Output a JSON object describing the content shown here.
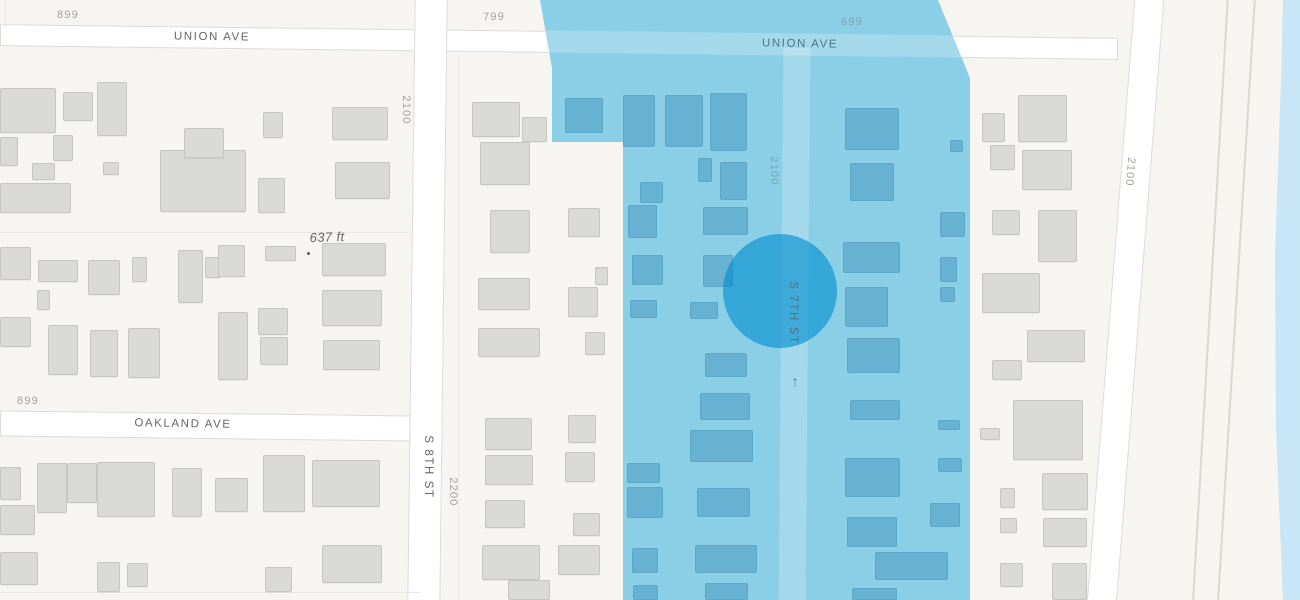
{
  "map": {
    "description": "street map with highlighted zone and circular marker",
    "colors": {
      "background": "#f6f5f1",
      "street": "#ffffff",
      "street_border": "#dcdbd5",
      "building": "#d9d9d7",
      "zone_fill": "#8bcfe7",
      "zone_building": "#67b2d3",
      "marker_circle": "rgba(0,140,206,0.62)",
      "water": "#c9e5f8",
      "street_name_text": "#666666",
      "block_number_text": "#a2a19e",
      "zone_name_text": "#4c7485",
      "zone_number_text": "#7fa2ad"
    },
    "streets": [
      {
        "cls": "street",
        "x": 0,
        "y": 31,
        "w": 1118,
        "h": 22,
        "rot": 0.7
      },
      {
        "cls": "street",
        "x": 0,
        "y": 413,
        "w": 416,
        "h": 26,
        "rot": 0.7
      },
      {
        "cls": "street",
        "x": 411,
        "y": -6,
        "w": 33,
        "h": 614,
        "rot": 0.7
      },
      {
        "cls": "street",
        "x": 1110,
        "y": -12,
        "w": 30,
        "h": 640,
        "rot": 4.5
      },
      {
        "cls": "path",
        "x": 1209,
        "y": -8,
        "w": 2,
        "h": 630,
        "rot": 3.3
      },
      {
        "cls": "path",
        "x": 1235,
        "y": -8,
        "w": 2,
        "h": 630,
        "rot": 3.5
      },
      {
        "cls": "hairline",
        "x": 5,
        "y": 0,
        "w": 1,
        "h": 28
      },
      {
        "cls": "hairline",
        "x": 0,
        "y": 232,
        "w": 408,
        "h": 1
      },
      {
        "cls": "hairline",
        "x": 0,
        "y": 592,
        "w": 420,
        "h": 1
      },
      {
        "cls": "hairline",
        "x": 458,
        "y": 55,
        "w": 1,
        "h": 545
      }
    ],
    "labels": [
      {
        "text": "899",
        "x": 68,
        "y": 15,
        "rot": 0,
        "cls": "num",
        "name": "label-block-number"
      },
      {
        "text": "UNION AVE",
        "x": 212,
        "y": 37,
        "rot": 0.7,
        "cls": "name",
        "name": "label-street-name"
      },
      {
        "text": "799",
        "x": 494,
        "y": 17,
        "rot": -1,
        "cls": "num",
        "name": "label-block-number"
      },
      {
        "text": "2100",
        "x": 406,
        "y": 110,
        "rot": 90,
        "cls": "num",
        "name": "label-block-number"
      },
      {
        "text": "2100",
        "x": 1130,
        "y": 172,
        "rot": 95,
        "cls": "num",
        "name": "label-block-number"
      },
      {
        "text": "637 ft",
        "x": 327,
        "y": 237,
        "rot": -2,
        "cls": "elev",
        "name": "label-elevation"
      },
      {
        "text": "899",
        "x": 28,
        "y": 401,
        "rot": 0,
        "cls": "num",
        "name": "label-block-number"
      },
      {
        "text": "OAKLAND AVE",
        "x": 183,
        "y": 424,
        "rot": 1,
        "cls": "name",
        "name": "label-street-name"
      },
      {
        "text": "S 8TH ST",
        "x": 428,
        "y": 467,
        "rot": 90,
        "cls": "name",
        "name": "label-street-name"
      },
      {
        "text": "2200",
        "x": 453,
        "y": 492,
        "rot": 90,
        "cls": "num",
        "name": "label-block-number"
      }
    ],
    "zone_labels": [
      {
        "text": "699",
        "x": 852,
        "y": 22,
        "rot": -1,
        "cls": "num on-zone",
        "name": "label-block-number"
      },
      {
        "text": "UNION AVE",
        "x": 800,
        "y": 44,
        "rot": 1,
        "cls": "name on-zone",
        "name": "label-street-name"
      },
      {
        "text": "2100",
        "x": 774,
        "y": 171,
        "rot": 90,
        "cls": "num on-zone",
        "name": "label-block-number"
      },
      {
        "text": "S 7TH ST",
        "x": 793,
        "y": 313,
        "rot": 90,
        "cls": "name on-zone",
        "name": "label-street-name"
      }
    ],
    "zone": {
      "polygon": [
        [
          540,
          0
        ],
        [
          938,
          0
        ],
        [
          970,
          78
        ],
        [
          970,
          600
        ],
        [
          623,
          600
        ],
        [
          623,
          142
        ],
        [
          552,
          142
        ],
        [
          552,
          68
        ]
      ],
      "inner_streets": [
        {
          "x": 538,
          "y": 33,
          "w": 436,
          "h": 22,
          "rot": 0.7
        },
        {
          "x": 781,
          "y": 48,
          "w": 27,
          "h": 552,
          "rot": 0.5
        }
      ],
      "circle": {
        "cx": 780,
        "cy": 291,
        "r": 57
      },
      "arrow": {
        "x": 795,
        "y": 382,
        "glyph": "↑"
      }
    },
    "elevation_dot": {
      "x": 307,
      "y": 252
    },
    "water": {
      "polygon": [
        [
          1283,
          0
        ],
        [
          1300,
          0
        ],
        [
          1300,
          600
        ],
        [
          1283,
          600
        ],
        [
          1276,
          430
        ],
        [
          1275,
          255
        ],
        [
          1281,
          80
        ]
      ]
    },
    "buildings": {
      "gray": [
        [
          0,
          88,
          56,
          45
        ],
        [
          63,
          92,
          30,
          29
        ],
        [
          97,
          82,
          30,
          54
        ],
        [
          0,
          137,
          18,
          29
        ],
        [
          53,
          135,
          20,
          26
        ],
        [
          32,
          163,
          23,
          17
        ],
        [
          103,
          162,
          16,
          13
        ],
        [
          0,
          183,
          71,
          30
        ],
        [
          160,
          150,
          86,
          62
        ],
        [
          184,
          128,
          40,
          30
        ],
        [
          263,
          112,
          20,
          26
        ],
        [
          258,
          178,
          27,
          35
        ],
        [
          332,
          107,
          56,
          33
        ],
        [
          335,
          162,
          55,
          37
        ],
        [
          0,
          247,
          31,
          33
        ],
        [
          38,
          260,
          40,
          22
        ],
        [
          37,
          290,
          13,
          20
        ],
        [
          88,
          260,
          32,
          35
        ],
        [
          132,
          257,
          15,
          25
        ],
        [
          178,
          250,
          25,
          53
        ],
        [
          205,
          257,
          15,
          21
        ],
        [
          218,
          245,
          27,
          32
        ],
        [
          265,
          246,
          31,
          15
        ],
        [
          322,
          243,
          64,
          33
        ],
        [
          0,
          317,
          31,
          30
        ],
        [
          48,
          325,
          30,
          50
        ],
        [
          90,
          330,
          28,
          47
        ],
        [
          128,
          328,
          32,
          50
        ],
        [
          218,
          312,
          30,
          68
        ],
        [
          258,
          308,
          30,
          27
        ],
        [
          260,
          337,
          28,
          28
        ],
        [
          322,
          290,
          60,
          36
        ],
        [
          323,
          340,
          57,
          30
        ],
        [
          0,
          467,
          21,
          33
        ],
        [
          37,
          463,
          30,
          50
        ],
        [
          67,
          463,
          30,
          40
        ],
        [
          97,
          462,
          58,
          55
        ],
        [
          172,
          468,
          30,
          49
        ],
        [
          215,
          478,
          33,
          34
        ],
        [
          263,
          455,
          42,
          57
        ],
        [
          312,
          460,
          68,
          47
        ],
        [
          0,
          505,
          35,
          30
        ],
        [
          0,
          552,
          38,
          33
        ],
        [
          97,
          562,
          23,
          30
        ],
        [
          127,
          563,
          21,
          24
        ],
        [
          265,
          567,
          27,
          25
        ],
        [
          322,
          545,
          60,
          38
        ],
        [
          472,
          102,
          48,
          35
        ],
        [
          522,
          117,
          25,
          25
        ],
        [
          480,
          142,
          50,
          43
        ],
        [
          490,
          210,
          40,
          43
        ],
        [
          568,
          208,
          32,
          29
        ],
        [
          478,
          278,
          52,
          32
        ],
        [
          568,
          287,
          30,
          30
        ],
        [
          595,
          267,
          13,
          18
        ],
        [
          478,
          328,
          62,
          29
        ],
        [
          585,
          332,
          20,
          23
        ],
        [
          485,
          418,
          47,
          32
        ],
        [
          568,
          415,
          28,
          28
        ],
        [
          485,
          455,
          48,
          30
        ],
        [
          565,
          452,
          30,
          30
        ],
        [
          485,
          500,
          40,
          28
        ],
        [
          573,
          513,
          27,
          23
        ],
        [
          482,
          545,
          58,
          35
        ],
        [
          558,
          545,
          42,
          30
        ],
        [
          508,
          580,
          42,
          20
        ],
        [
          982,
          113,
          23,
          29
        ],
        [
          1018,
          95,
          49,
          47
        ],
        [
          990,
          145,
          25,
          25
        ],
        [
          1022,
          150,
          50,
          40
        ],
        [
          992,
          210,
          28,
          25
        ],
        [
          1038,
          210,
          39,
          52
        ],
        [
          982,
          273,
          58,
          40
        ],
        [
          1027,
          330,
          58,
          32
        ],
        [
          992,
          360,
          30,
          20
        ],
        [
          1013,
          400,
          70,
          60
        ],
        [
          980,
          428,
          20,
          12
        ],
        [
          1042,
          473,
          46,
          37
        ],
        [
          1000,
          488,
          15,
          20
        ],
        [
          1000,
          518,
          17,
          15
        ],
        [
          1043,
          518,
          44,
          29
        ],
        [
          1000,
          563,
          23,
          24
        ],
        [
          1052,
          563,
          35,
          37
        ]
      ],
      "zone": [
        [
          565,
          98,
          38,
          35
        ],
        [
          623,
          95,
          32,
          52
        ],
        [
          665,
          95,
          38,
          52
        ],
        [
          710,
          93,
          37,
          58
        ],
        [
          640,
          182,
          23,
          21
        ],
        [
          628,
          205,
          29,
          33
        ],
        [
          698,
          158,
          14,
          24
        ],
        [
          720,
          162,
          27,
          38
        ],
        [
          703,
          207,
          45,
          28
        ],
        [
          632,
          255,
          31,
          30
        ],
        [
          703,
          255,
          30,
          32
        ],
        [
          630,
          300,
          27,
          18
        ],
        [
          690,
          302,
          28,
          17
        ],
        [
          705,
          353,
          42,
          24
        ],
        [
          700,
          393,
          50,
          27
        ],
        [
          690,
          430,
          63,
          32
        ],
        [
          627,
          463,
          33,
          20
        ],
        [
          627,
          487,
          36,
          31
        ],
        [
          697,
          488,
          53,
          29
        ],
        [
          632,
          548,
          26,
          25
        ],
        [
          695,
          545,
          62,
          28
        ],
        [
          633,
          585,
          25,
          15
        ],
        [
          705,
          583,
          43,
          17
        ],
        [
          845,
          108,
          54,
          42
        ],
        [
          850,
          163,
          44,
          38
        ],
        [
          950,
          140,
          13,
          12
        ],
        [
          940,
          212,
          25,
          25
        ],
        [
          843,
          242,
          57,
          31
        ],
        [
          940,
          257,
          17,
          25
        ],
        [
          845,
          287,
          43,
          40
        ],
        [
          940,
          287,
          15,
          15
        ],
        [
          847,
          338,
          53,
          35
        ],
        [
          850,
          400,
          50,
          20
        ],
        [
          938,
          420,
          22,
          10
        ],
        [
          845,
          458,
          55,
          39
        ],
        [
          938,
          458,
          24,
          14
        ],
        [
          930,
          503,
          30,
          24
        ],
        [
          847,
          517,
          50,
          30
        ],
        [
          875,
          552,
          73,
          28
        ],
        [
          852,
          588,
          45,
          12
        ]
      ]
    }
  }
}
